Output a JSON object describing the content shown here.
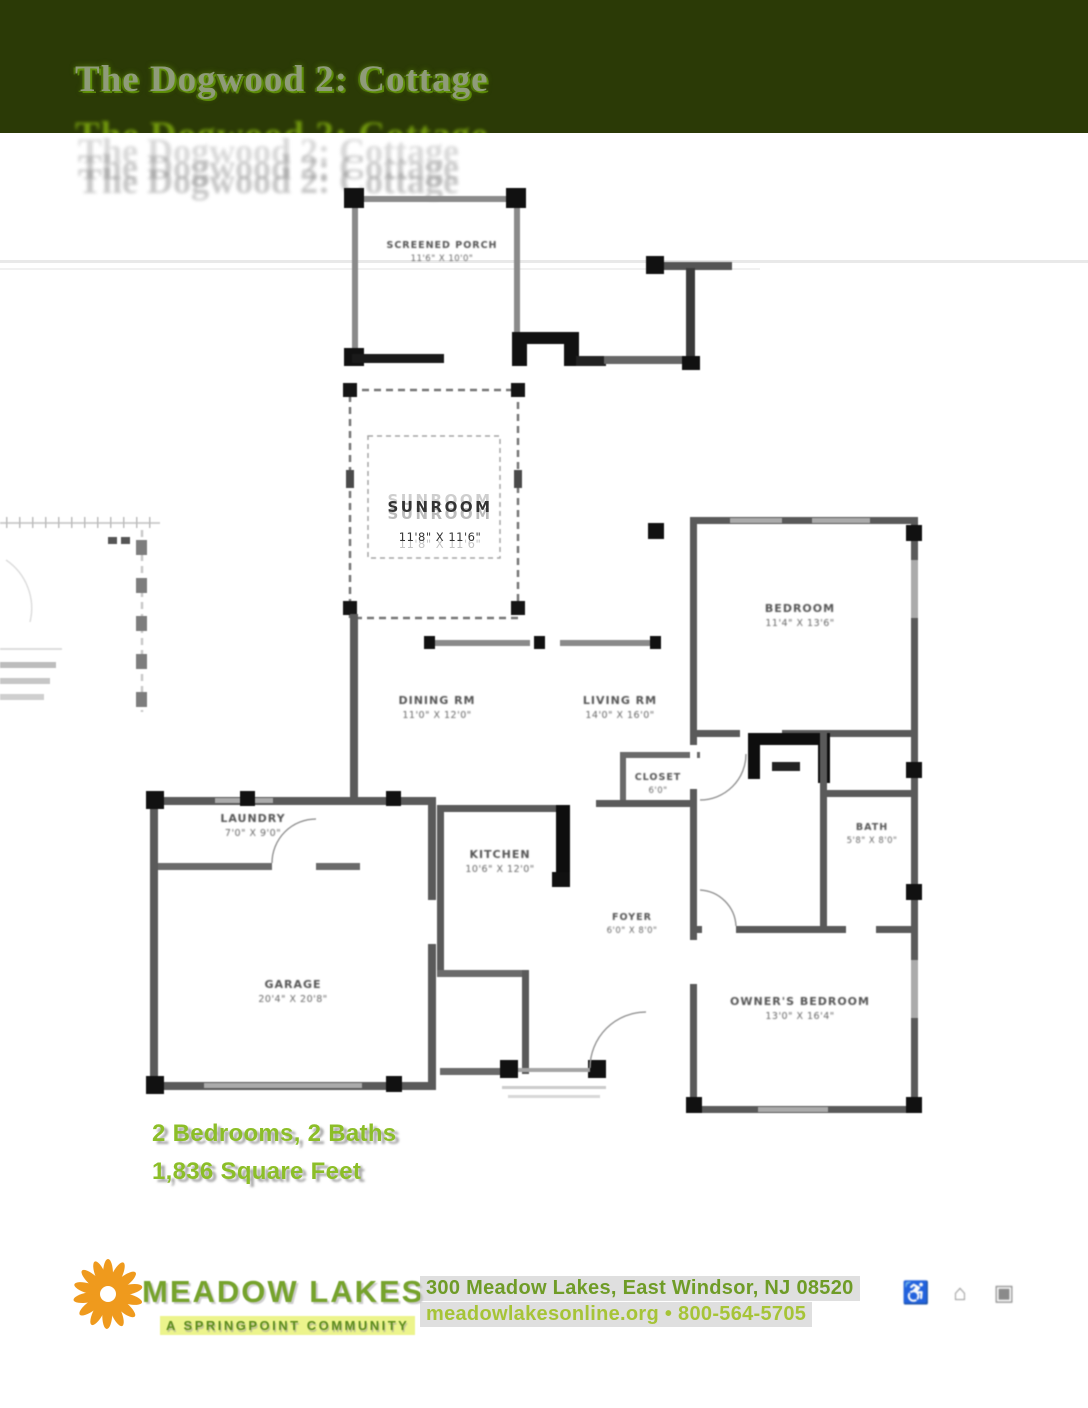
{
  "header": {
    "title": "The Dogwood 2: Cottage",
    "band_color": "#2b3a06"
  },
  "plan": {
    "rooms": [
      {
        "id": "screened-porch",
        "name": "SCREENED PORCH",
        "dims": "11'6\" X 10'0\""
      },
      {
        "id": "sunroom",
        "name": "SUNROOM",
        "dims": "11'8\" X 11'6\""
      },
      {
        "id": "bedroom",
        "name": "BEDROOM",
        "dims": "11'4\" X 13'6\""
      },
      {
        "id": "dining-room",
        "name": "DINING RM",
        "dims": "11'0\" X 12'0\""
      },
      {
        "id": "living-room",
        "name": "LIVING RM",
        "dims": "14'0\" X 16'0\""
      },
      {
        "id": "closet",
        "name": "CLOSET",
        "dims": "6'0\""
      },
      {
        "id": "bath",
        "name": "BATH",
        "dims": "5'8\" X 8'0\""
      },
      {
        "id": "laundry",
        "name": "LAUNDRY",
        "dims": "7'0\" X 9'0\""
      },
      {
        "id": "kitchen",
        "name": "KITCHEN",
        "dims": "10'6\" X 12'0\""
      },
      {
        "id": "foyer",
        "name": "FOYER",
        "dims": "6'0\" X 8'0\""
      },
      {
        "id": "garage",
        "name": "GARAGE",
        "dims": "20'4\" X 20'8\""
      },
      {
        "id": "owners-bedroom",
        "name": "OWNER'S BEDROOM",
        "dims": "13'0\" X 16'4\""
      }
    ]
  },
  "stats": {
    "line1": "2 Bedrooms, 2 Baths",
    "line2": "1,836 Square Feet",
    "accent_color": "#8cbe28"
  },
  "footer": {
    "logo_name": "MEADOW LAKES",
    "logo_tagline": "A SPRINGPOINT COMMUNITY",
    "address_line1": "300 Meadow Lakes, East Windsor, NJ 08520",
    "address_line2": "meadowlakesonline.org • 800-564-5705",
    "logo_orange": "#ef9a1d",
    "logo_green": "#76a32c",
    "icons": [
      {
        "id": "wheelchair-accessible-icon",
        "glyph": "♿"
      },
      {
        "id": "equal-housing-icon",
        "glyph": "⌂"
      },
      {
        "id": "accreditation-icon",
        "glyph": "▣"
      }
    ]
  }
}
